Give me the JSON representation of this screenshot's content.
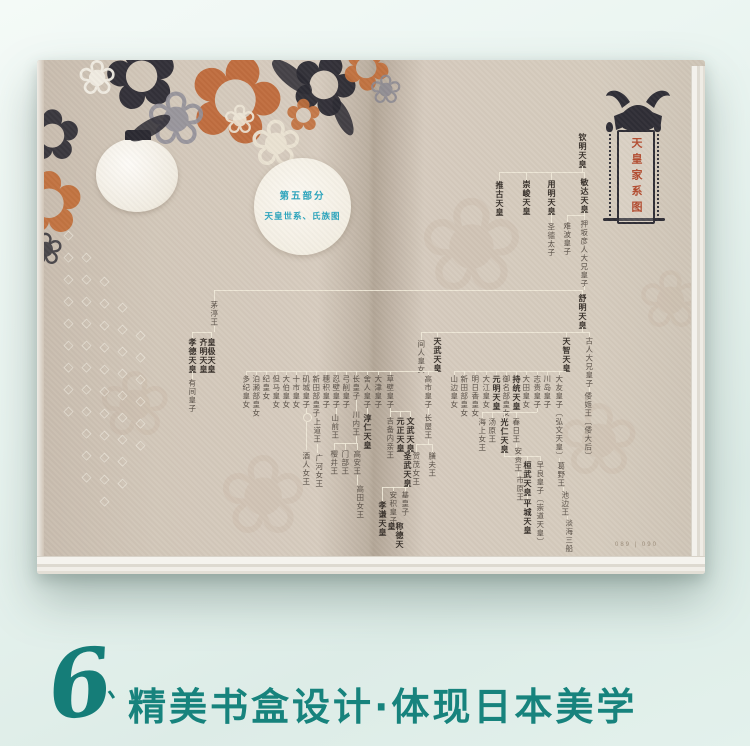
{
  "caption": {
    "numeral": "6",
    "tick": "、",
    "text": "精美书盒设计·体现日本美学",
    "color": "#17837d"
  },
  "left_page": {
    "section_badge": {
      "line1": "第五部分",
      "line2": "天皇世系、氏族图",
      "text_color": "#2aa4bd"
    }
  },
  "right_page": {
    "crest": {
      "title": "天皇家系图",
      "title_color": "#b34a2e",
      "icon": "kabuto-helmet-icon"
    },
    "page_number": "089 | 090"
  },
  "tree": {
    "text_color": "#5a5148",
    "line_color": "#f1ead9",
    "nodes": [
      {
        "t": "钦明天皇",
        "x": 545,
        "y": 73,
        "b": 1
      },
      {
        "t": "推古天皇",
        "x": 462,
        "y": 121,
        "b": 1
      },
      {
        "t": "崇峻天皇",
        "x": 489,
        "y": 120,
        "b": 1
      },
      {
        "t": "用明天皇",
        "x": 514,
        "y": 120,
        "b": 1
      },
      {
        "t": "敏达天皇",
        "x": 547,
        "y": 118,
        "b": 1
      },
      {
        "t": "圣德太子",
        "x": 514,
        "y": 163
      },
      {
        "t": "难波皇子",
        "x": 530,
        "y": 162
      },
      {
        "t": "押坂彦人大兄皇子",
        "x": 547,
        "y": 160
      },
      {
        "t": "舒明天皇",
        "x": 545,
        "y": 234,
        "b": 1
      },
      {
        "t": "茅渟王",
        "x": 177,
        "y": 241
      },
      {
        "t": "孝德天皇",
        "x": 155,
        "y": 278,
        "b": 1
      },
      {
        "t": "皇极天皇\n齐明天皇",
        "x": 170,
        "y": 278,
        "b": 1
      },
      {
        "t": "有间皇子",
        "x": 155,
        "y": 319
      },
      {
        "t": "间人皇女",
        "x": 384,
        "y": 280
      },
      {
        "t": "天武天皇",
        "x": 400,
        "y": 277,
        "b": 1
      },
      {
        "t": "天智天皇",
        "x": 529,
        "y": 277,
        "b": 1
      },
      {
        "t": "古人大兄皇子",
        "x": 552,
        "y": 277
      },
      {
        "t": "倭姬王〔倭大后〕",
        "x": 551,
        "y": 332
      },
      {
        "t": "山边皇女",
        "x": 417,
        "y": 315
      },
      {
        "t": "新田部皇女",
        "x": 427,
        "y": 315
      },
      {
        "t": "明日香皇女",
        "x": 438,
        "y": 315
      },
      {
        "t": "大江皇女",
        "x": 449,
        "y": 315
      },
      {
        "t": "元明天皇",
        "x": 459,
        "y": 315,
        "b": 1
      },
      {
        "t": "御名部皇女",
        "x": 469,
        "y": 315
      },
      {
        "t": "持统天皇",
        "x": 479,
        "y": 315,
        "b": 1
      },
      {
        "t": "大田皇女",
        "x": 489,
        "y": 315
      },
      {
        "t": "志贵皇子",
        "x": 500,
        "y": 315
      },
      {
        "t": "川岛皇子",
        "x": 510,
        "y": 315
      },
      {
        "t": "大友皇子〔弘文天皇〕",
        "x": 522,
        "y": 315
      },
      {
        "t": "葛野王",
        "x": 524,
        "y": 402
      },
      {
        "t": "池边王",
        "x": 528,
        "y": 431
      },
      {
        "t": "淡海三船",
        "x": 532,
        "y": 459
      },
      {
        "t": "海上女王",
        "x": 445,
        "y": 358
      },
      {
        "t": "汤原王",
        "x": 455,
        "y": 358
      },
      {
        "t": "光仁天皇",
        "x": 467,
        "y": 358,
        "b": 1
      },
      {
        "t": "春日王",
        "x": 479,
        "y": 358
      },
      {
        "t": "安贵王",
        "x": 481,
        "y": 387
      },
      {
        "t": "市原王",
        "x": 483,
        "y": 416
      },
      {
        "t": "桓武天皇",
        "x": 490,
        "y": 401,
        "b": 1
      },
      {
        "t": "早良皇子〔崇道天皇〕",
        "x": 503,
        "y": 401
      },
      {
        "t": "平城天皇",
        "x": 490,
        "y": 439,
        "b": 1
      },
      {
        "t": "多纪皇女",
        "x": 209,
        "y": 315
      },
      {
        "t": "泊濑部皇女",
        "x": 219,
        "y": 315
      },
      {
        "t": "纪皇女",
        "x": 229,
        "y": 315
      },
      {
        "t": "但马皇女",
        "x": 239,
        "y": 315
      },
      {
        "t": "大伯皇女",
        "x": 249,
        "y": 315
      },
      {
        "t": "十市皇女",
        "x": 259,
        "y": 315
      },
      {
        "t": "矶城皇子",
        "x": 269,
        "y": 315
      },
      {
        "t": "新田部皇子",
        "x": 279,
        "y": 315
      },
      {
        "t": "穗积皇子",
        "x": 289,
        "y": 315
      },
      {
        "t": "忍壁皇子",
        "x": 299,
        "y": 315
      },
      {
        "t": "弓削皇子",
        "x": 309,
        "y": 315
      },
      {
        "t": "长皇子",
        "x": 319,
        "y": 315
      },
      {
        "t": "舍人皇子",
        "x": 330,
        "y": 315
      },
      {
        "t": "大津皇子",
        "x": 341,
        "y": 315
      },
      {
        "t": "草壁皇子",
        "x": 353,
        "y": 315
      },
      {
        "t": "高市皇子",
        "x": 391,
        "y": 315
      },
      {
        "t": "酒人女王",
        "x": 269,
        "y": 392
      },
      {
        "t": "上道王",
        "x": 280,
        "y": 358
      },
      {
        "t": "广河女王",
        "x": 282,
        "y": 394
      },
      {
        "t": "山前王",
        "x": 298,
        "y": 354
      },
      {
        "t": "川内王",
        "x": 319,
        "y": 351
      },
      {
        "t": "樱井王",
        "x": 297,
        "y": 390
      },
      {
        "t": "门部王",
        "x": 308,
        "y": 390
      },
      {
        "t": "高安王",
        "x": 320,
        "y": 390
      },
      {
        "t": "高田女王",
        "x": 323,
        "y": 425
      },
      {
        "t": "淳仁天皇",
        "x": 330,
        "y": 354,
        "b": 1
      },
      {
        "t": "吉备内亲王",
        "x": 353,
        "y": 357
      },
      {
        "t": "元正天皇",
        "x": 363,
        "y": 357,
        "b": 1
      },
      {
        "t": "文武天皇",
        "x": 373,
        "y": 357,
        "b": 1
      },
      {
        "t": "圣武天皇",
        "x": 370,
        "y": 392,
        "b": 1
      },
      {
        "t": "孝谦天皇",
        "x": 345,
        "y": 441,
        "b": 1
      },
      {
        "t": "安积皇子",
        "x": 356,
        "y": 431
      },
      {
        "t": "基皇子",
        "x": 368,
        "y": 431
      },
      {
        "t": "称德天皇",
        "x": 358,
        "y": 462,
        "b": 1
      },
      {
        "t": "长屋王",
        "x": 391,
        "y": 354
      },
      {
        "t": "贺茂女王",
        "x": 379,
        "y": 392
      },
      {
        "t": "膳夫王",
        "x": 395,
        "y": 392
      }
    ],
    "circles": [
      {
        "x": 269,
        "y": 356
      }
    ],
    "lines": [
      [
        545,
        106,
        1,
        6
      ],
      [
        462,
        112,
        86,
        1
      ],
      [
        462,
        112,
        1,
        8
      ],
      [
        489,
        112,
        1,
        8
      ],
      [
        514,
        112,
        1,
        8
      ],
      [
        547,
        112,
        1,
        6
      ],
      [
        514,
        153,
        1,
        10
      ],
      [
        547,
        151,
        1,
        4
      ],
      [
        530,
        155,
        18,
        1
      ],
      [
        530,
        155,
        1,
        7
      ],
      [
        547,
        155,
        1,
        5
      ],
      [
        547,
        226,
        1,
        4
      ],
      [
        177,
        230,
        369,
        1
      ],
      [
        177,
        230,
        1,
        11
      ],
      [
        545,
        230,
        1,
        4
      ],
      [
        545,
        267,
        1,
        5
      ],
      [
        384,
        272,
        168,
        1
      ],
      [
        384,
        272,
        1,
        8
      ],
      [
        400,
        272,
        1,
        5
      ],
      [
        529,
        272,
        1,
        5
      ],
      [
        552,
        272,
        1,
        5
      ],
      [
        177,
        266,
        1,
        6
      ],
      [
        155,
        272,
        20,
        1
      ],
      [
        155,
        272,
        1,
        6
      ],
      [
        174,
        272,
        1,
        6
      ],
      [
        155,
        311,
        1,
        8
      ],
      [
        209,
        311,
        192,
        1
      ],
      [
        417,
        311,
        112,
        1
      ],
      [
        209,
        311,
        1,
        4
      ],
      [
        219,
        311,
        1,
        4
      ],
      [
        229,
        311,
        1,
        4
      ],
      [
        239,
        311,
        1,
        4
      ],
      [
        249,
        311,
        1,
        4
      ],
      [
        259,
        311,
        1,
        4
      ],
      [
        269,
        311,
        1,
        4
      ],
      [
        279,
        311,
        1,
        4
      ],
      [
        289,
        311,
        1,
        4
      ],
      [
        299,
        311,
        1,
        4
      ],
      [
        309,
        311,
        1,
        4
      ],
      [
        319,
        311,
        1,
        4
      ],
      [
        330,
        311,
        1,
        4
      ],
      [
        341,
        311,
        1,
        4
      ],
      [
        353,
        311,
        1,
        4
      ],
      [
        391,
        311,
        1,
        4
      ],
      [
        417,
        311,
        1,
        4
      ],
      [
        427,
        311,
        1,
        4
      ],
      [
        438,
        311,
        1,
        4
      ],
      [
        449,
        311,
        1,
        4
      ],
      [
        459,
        311,
        1,
        4
      ],
      [
        469,
        311,
        1,
        4
      ],
      [
        479,
        311,
        1,
        4
      ],
      [
        489,
        311,
        1,
        4
      ],
      [
        500,
        311,
        1,
        4
      ],
      [
        510,
        311,
        1,
        4
      ],
      [
        522,
        311,
        1,
        4
      ],
      [
        552,
        327,
        1,
        5
      ],
      [
        500,
        348,
        1,
        4
      ],
      [
        445,
        352,
        55,
        1
      ],
      [
        445,
        352,
        1,
        6
      ],
      [
        455,
        352,
        1,
        6
      ],
      [
        467,
        352,
        1,
        6
      ],
      [
        479,
        352,
        1,
        6
      ],
      [
        479,
        383,
        1,
        4
      ],
      [
        481,
        412,
        1,
        4
      ],
      [
        467,
        391,
        1,
        5
      ],
      [
        467,
        396,
        36,
        1
      ],
      [
        490,
        396,
        1,
        5
      ],
      [
        503,
        396,
        1,
        5
      ],
      [
        490,
        434,
        1,
        5
      ],
      [
        522,
        398,
        1,
        4
      ],
      [
        526,
        427,
        1,
        4
      ],
      [
        530,
        456,
        1,
        3
      ],
      [
        330,
        348,
        1,
        6
      ],
      [
        319,
        340,
        1,
        11
      ],
      [
        319,
        376,
        1,
        7
      ],
      [
        297,
        383,
        23,
        1
      ],
      [
        297,
        383,
        1,
        7
      ],
      [
        308,
        383,
        1,
        7
      ],
      [
        320,
        383,
        1,
        7
      ],
      [
        320,
        415,
        1,
        10
      ],
      [
        353,
        348,
        1,
        3
      ],
      [
        353,
        351,
        20,
        1
      ],
      [
        353,
        351,
        1,
        6
      ],
      [
        363,
        351,
        1,
        6
      ],
      [
        373,
        351,
        1,
        6
      ],
      [
        373,
        390,
        1,
        2
      ],
      [
        371,
        425,
        1,
        2
      ],
      [
        345,
        427,
        26,
        1
      ],
      [
        345,
        427,
        1,
        14
      ],
      [
        356,
        427,
        1,
        4
      ],
      [
        368,
        427,
        1,
        4
      ],
      [
        391,
        348,
        1,
        6
      ],
      [
        391,
        379,
        1,
        5
      ],
      [
        379,
        384,
        16,
        1
      ],
      [
        379,
        384,
        1,
        8
      ],
      [
        395,
        384,
        1,
        8
      ],
      [
        269,
        348,
        1,
        5
      ],
      [
        269,
        362,
        1,
        28
      ],
      [
        299,
        348,
        1,
        6
      ],
      [
        280,
        384,
        1,
        9
      ]
    ]
  },
  "decor": {
    "flowers": [
      {
        "g": "✿",
        "x": 148,
        "y": -20,
        "s": 120,
        "c": "#bf6a3a",
        "o": 0.96,
        "r": 15
      },
      {
        "g": "✿",
        "x": 66,
        "y": -30,
        "s": 92,
        "c": "#2b2a32",
        "o": 0.95,
        "r": -10
      },
      {
        "g": "✿",
        "x": 252,
        "y": -18,
        "s": 84,
        "c": "#2b2a32",
        "o": 0.95,
        "r": 20
      },
      {
        "g": "❀",
        "x": 108,
        "y": 22,
        "s": 74,
        "c": "#93919a",
        "o": 0.9,
        "r": 0
      },
      {
        "g": "❀",
        "x": 212,
        "y": 52,
        "s": 64,
        "c": "#ece4d4",
        "o": 0.95,
        "r": 0
      },
      {
        "g": "✿",
        "x": -14,
        "y": 40,
        "s": 70,
        "c": "#2b2a32",
        "o": 0.9,
        "r": 0
      },
      {
        "g": "✿",
        "x": -24,
        "y": 100,
        "s": 86,
        "c": "#c2703c",
        "o": 0.95,
        "r": 0
      },
      {
        "g": "✿",
        "x": 304,
        "y": -22,
        "s": 60,
        "c": "#c2703c",
        "o": 0.95,
        "r": 30
      },
      {
        "g": "❀",
        "x": 40,
        "y": -6,
        "s": 48,
        "c": "#f2eee4",
        "o": 0.95,
        "r": 0
      },
      {
        "g": "✿",
        "x": 248,
        "y": 34,
        "s": 44,
        "c": "#c2703c",
        "o": 0.9,
        "r": 0
      },
      {
        "g": "❀",
        "x": 332,
        "y": 10,
        "s": 40,
        "c": "#8b8992",
        "o": 0.85,
        "r": 0
      },
      {
        "g": "❀",
        "x": -10,
        "y": 168,
        "s": 44,
        "c": "#2b2a32",
        "o": 0.8,
        "r": 0
      },
      {
        "g": "❀",
        "x": 186,
        "y": 40,
        "s": 40,
        "c": "#efe7d8",
        "o": 0.9,
        "r": 0
      }
    ],
    "leaves": [
      {
        "x": 230,
        "y": 8,
        "w": 50,
        "h": 18,
        "r": 40
      },
      {
        "x": 90,
        "y": 60,
        "w": 46,
        "h": 16,
        "r": -30
      },
      {
        "x": 286,
        "y": 50,
        "w": 40,
        "h": 14,
        "r": 65
      }
    ],
    "diamond_columns": [
      {
        "x": 26,
        "y": 168,
        "n": 9
      },
      {
        "x": 44,
        "y": 190,
        "n": 11
      },
      {
        "x": 62,
        "y": 214,
        "n": 11
      },
      {
        "x": 80,
        "y": 240,
        "n": 9
      },
      {
        "x": 98,
        "y": 268,
        "n": 6
      }
    ],
    "watermarks": [
      {
        "g": "❀",
        "x": 380,
        "y": 120,
        "s": 130
      },
      {
        "g": "❀",
        "x": 520,
        "y": 330,
        "s": 100
      },
      {
        "g": "❀",
        "x": 180,
        "y": 380,
        "s": 110
      },
      {
        "g": "❀",
        "x": 600,
        "y": 200,
        "s": 80
      },
      {
        "g": "❀",
        "x": 60,
        "y": 300,
        "s": 90
      }
    ]
  }
}
